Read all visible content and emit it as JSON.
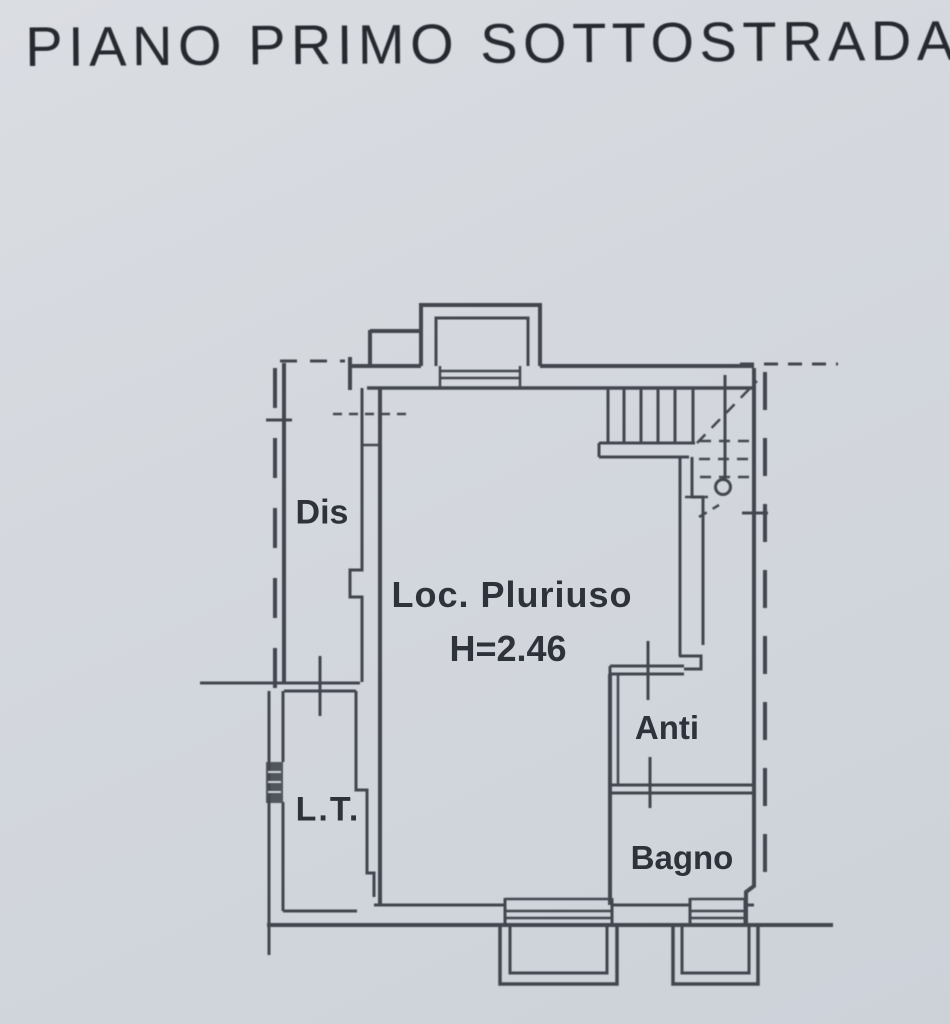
{
  "title": "PIANO PRIMO SOTTOSTRADA",
  "rooms": {
    "dis": {
      "label": "Dis"
    },
    "loc_pluriuso": {
      "label": "Loc. Pluriuso",
      "height_note": "H=2.46"
    },
    "anti": {
      "label": "Anti"
    },
    "bagno": {
      "label": "Bagno"
    },
    "lt": {
      "label": "L.T."
    }
  },
  "colors": {
    "paper": "#d4d8de",
    "ink": "#3b3f47",
    "title_ink": "#26292f",
    "label_ink": "#2e323a"
  }
}
